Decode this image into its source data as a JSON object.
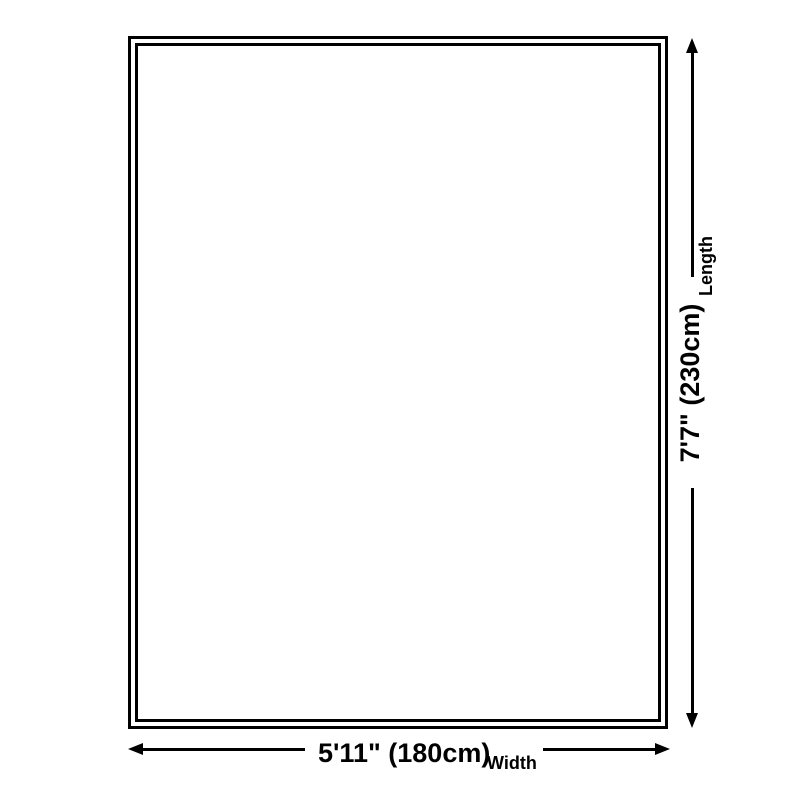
{
  "colors": {
    "line": "#000000",
    "background": "#ffffff"
  },
  "diagram": {
    "width_dimension": {
      "value": "5'11\" (180cm)",
      "label": "Width"
    },
    "length_dimension": {
      "value": "7'7\" (230cm)",
      "label": "Length"
    }
  }
}
